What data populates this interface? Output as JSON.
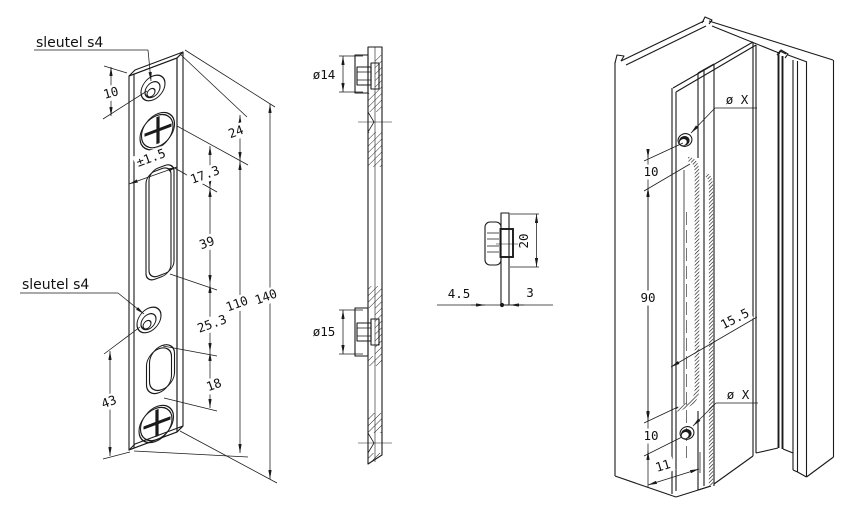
{
  "drawing": {
    "background": "#ffffff",
    "line_color": "#1a1a1a",
    "front_view": {
      "label_top": "sleutel s4",
      "label_bottom": "sleutel s4",
      "dim_hole_offset": "10",
      "dim_top_to_screw": "24",
      "dim_tolerance": "±1.5",
      "dim_screw_to_slot": "17.3",
      "dim_slot_length": "39",
      "dim_slot_to_hole": "25.3",
      "dim_oval_length": "18",
      "dim_screw_span": "110",
      "dim_total_height": "140",
      "dim_hole_to_bottom": "43"
    },
    "section_view": {
      "dim_boss_top": "ø14",
      "dim_boss_bottom": "ø15"
    },
    "detail_view": {
      "dim_depth": "4.5",
      "dim_thickness": "3",
      "dim_height": "20"
    },
    "iso_view": {
      "dim_hole_top": "ø X",
      "dim_hole_top_offset": "10",
      "dim_groove_length": "90",
      "dim_groove_width": "15.5",
      "dim_hole_bottom": "ø X",
      "dim_hole_bottom_offset": "10",
      "dim_edge_offset": "11"
    }
  }
}
